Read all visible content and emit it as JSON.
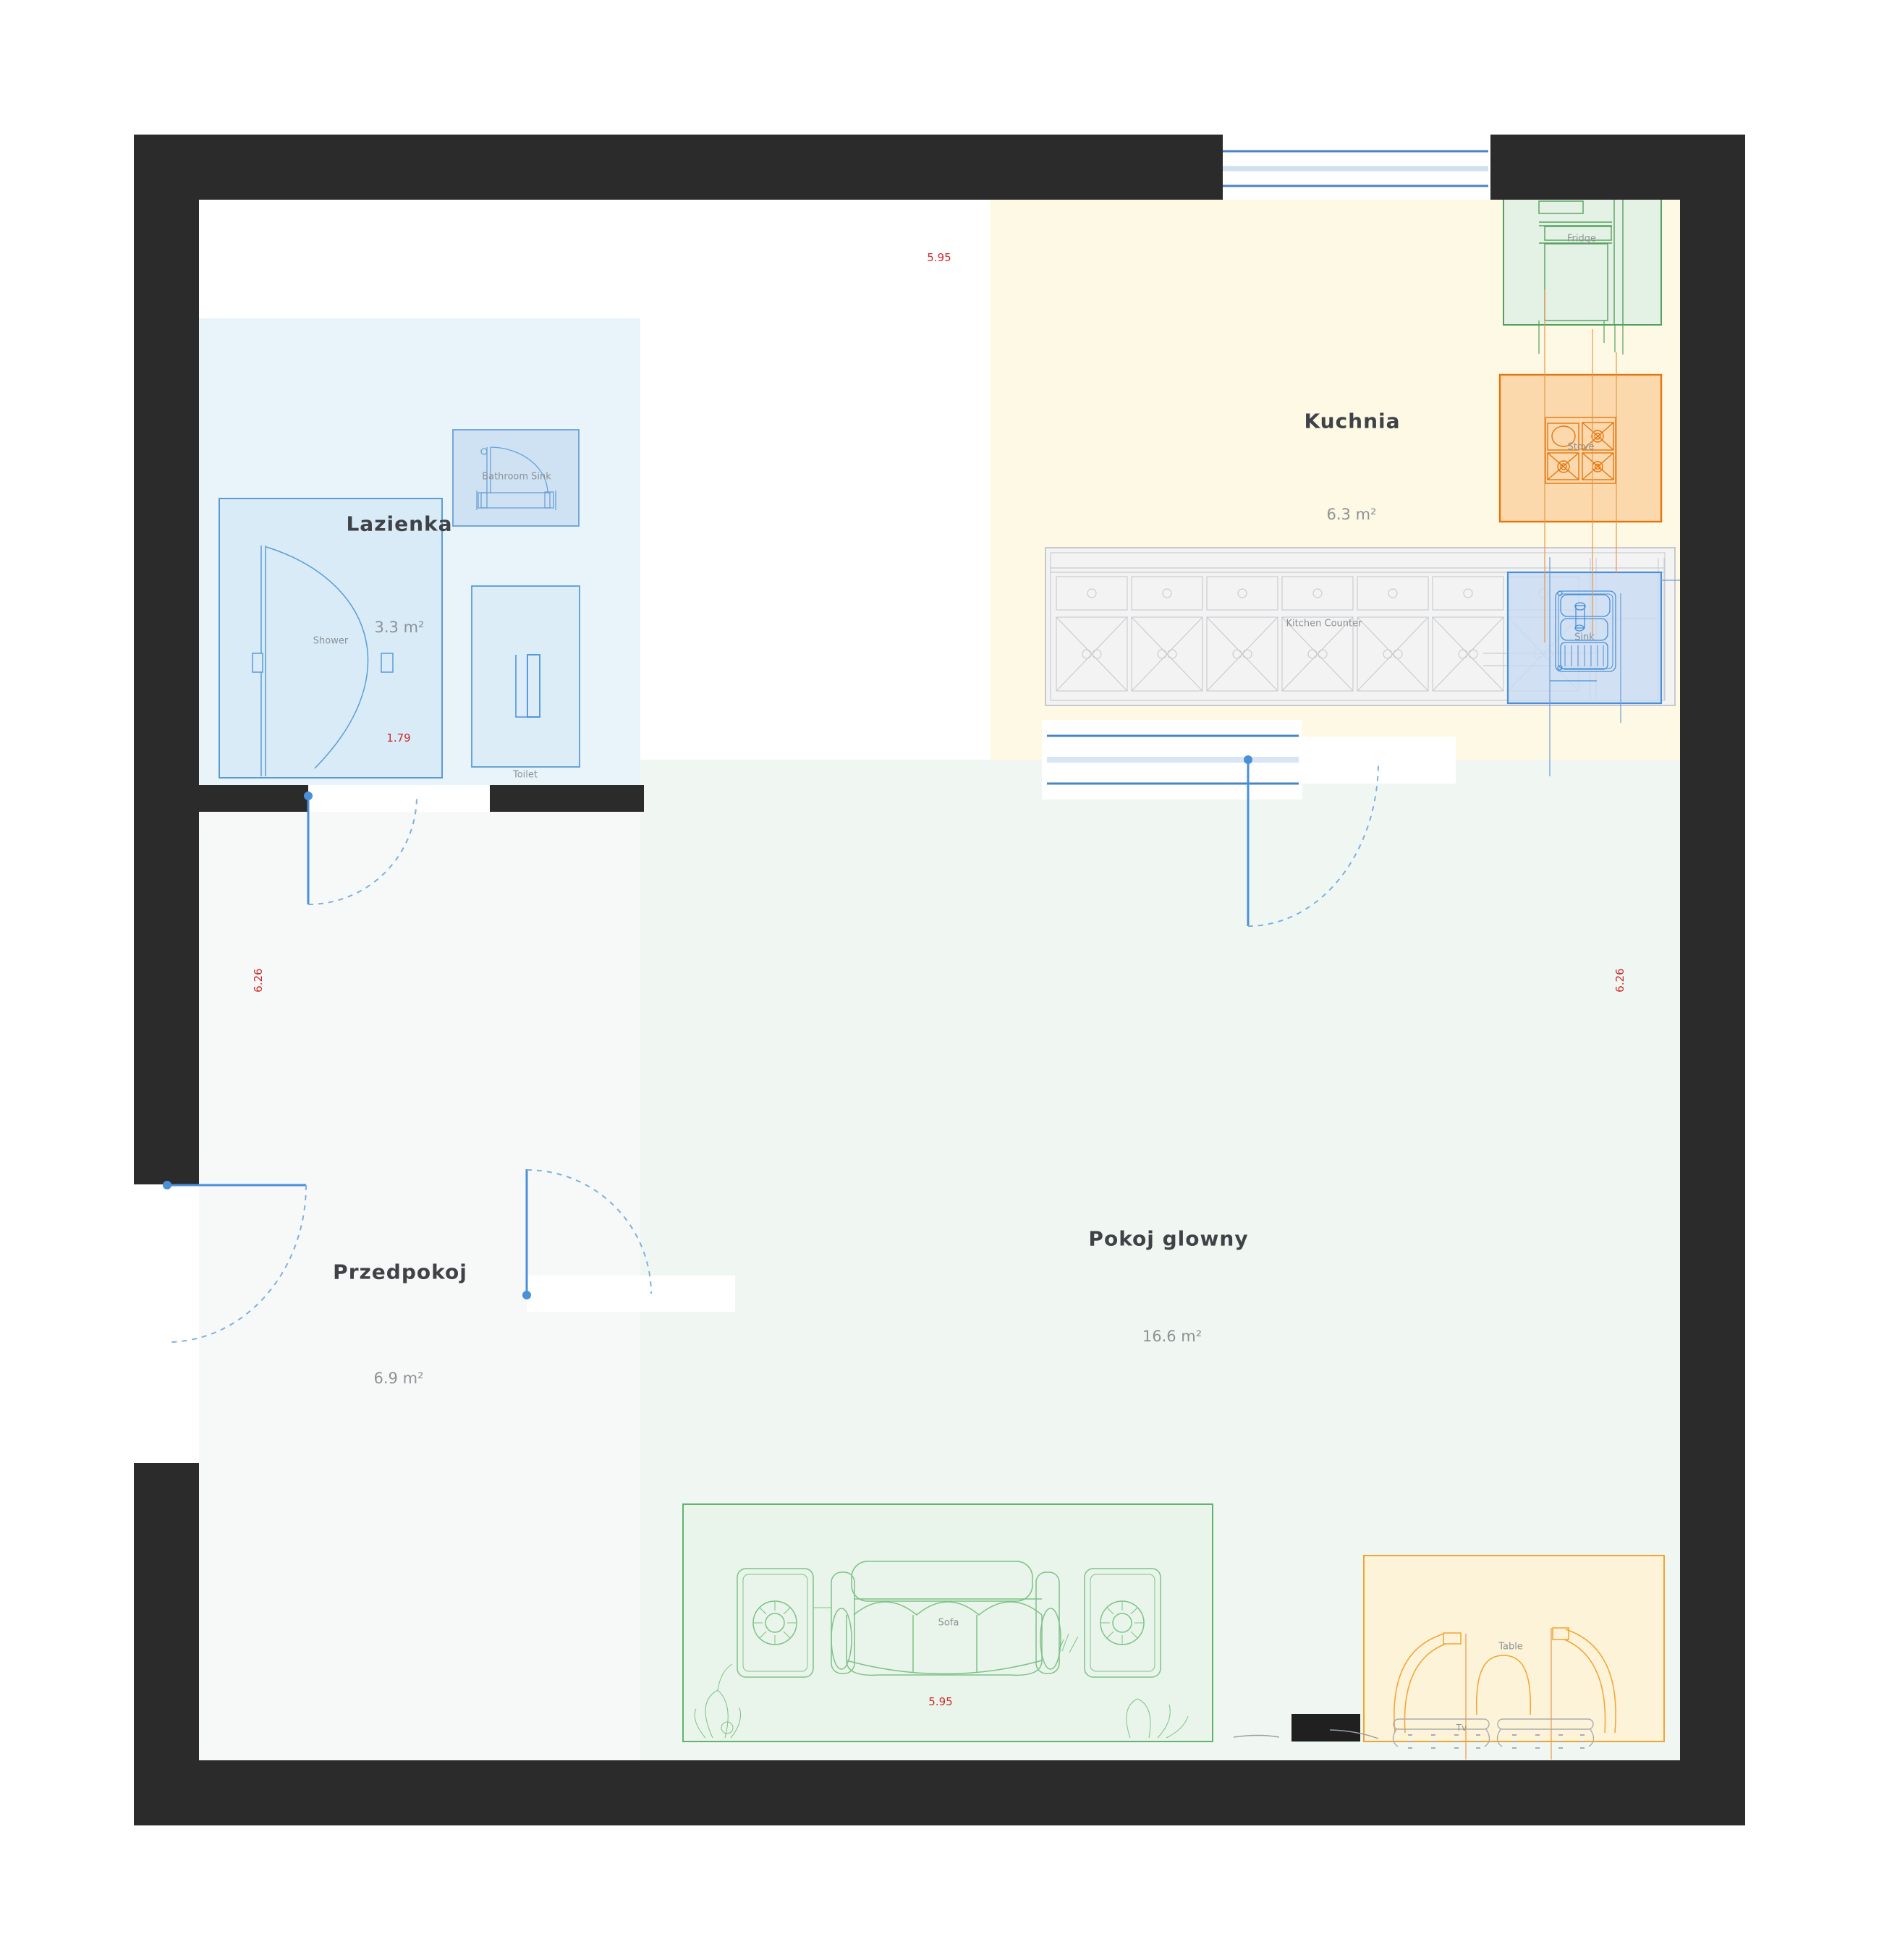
{
  "title": "Apartment floor plan",
  "rooms": [
    {
      "name": "Lazienka",
      "area": "3.3 m²"
    },
    {
      "name": "Kuchnia",
      "area": "6.3 m²"
    },
    {
      "name": "Przedpokoj",
      "area": "6.9 m²"
    },
    {
      "name": "Pokoj glowny",
      "area": "16.6 m²"
    }
  ],
  "furniture": {
    "shower": "Shower",
    "bathroom_sink": "Bathroom Sink",
    "toilet": "Toilet",
    "fridge": "Fridge",
    "stove": "Stove",
    "kitchen_counter": "Kitchen Counter",
    "sink": "Sink",
    "sofa": "Sofa",
    "table": "Table",
    "tv": "Tv"
  },
  "dimensions": {
    "top_width": "5.95",
    "bottom_width": "5.95",
    "left_height": "6.26",
    "right_height": "6.26",
    "shower_width": "1.79"
  },
  "colors": {
    "wall": "#2b2b2c",
    "door_blue": "#4a90d9",
    "window_blue": "#4a84c4",
    "dimension_red": "#cc2a2a",
    "room_label": "#3f4246",
    "secondary_label": "#8d9296",
    "lazienka_floor": "#e8f4fa",
    "kuchnia_floor": "#fdf9e4",
    "przedpokoj_floor": "#f7f8f8",
    "pokoj_glowny_floor": "#f0f7f2",
    "fridge_green": "#55a05e",
    "stove_orange": "#e7750f",
    "table_orange": "#f2a431",
    "sofa_green": "#62b36c"
  }
}
